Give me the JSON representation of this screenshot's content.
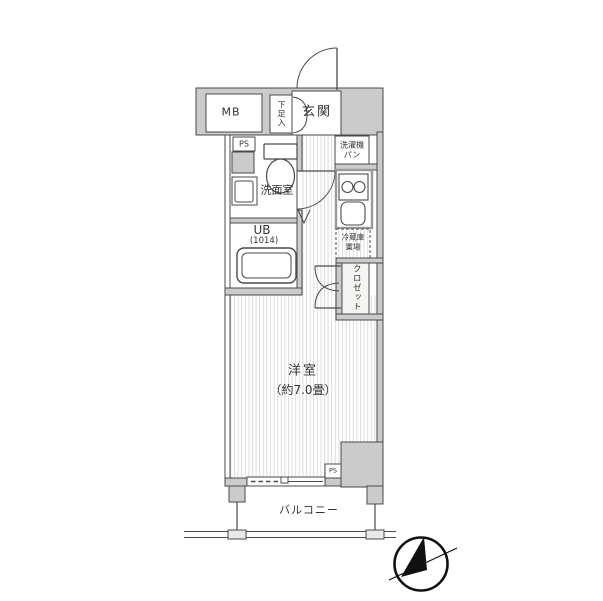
{
  "floorplan": {
    "rooms": {
      "mb": "MB",
      "shoe_cabinet": "下足入",
      "entrance": "玄関",
      "pipe_space_upper": "PS",
      "washroom": "洗面室",
      "washing_machine_pan_line1": "洗濯機",
      "washing_machine_pan_line2": "パン",
      "unit_bath": "UB",
      "unit_bath_size": "(1014)",
      "refrigerator_space_line1": "冷蔵庫",
      "refrigerator_space_line2": "置場",
      "closet": "クロゼット",
      "western_room": "洋室",
      "western_room_size": "（約7.0畳）",
      "pipe_space_lower": "PS",
      "balcony": "バルコニー"
    },
    "colors": {
      "wall_fill": "#cbcbcb",
      "outline": "#4a4a4a",
      "floor_stripe": "#dcdcdc",
      "counter_border": "#9a9a9a",
      "compass": "#111111",
      "text": "#333333"
    }
  }
}
